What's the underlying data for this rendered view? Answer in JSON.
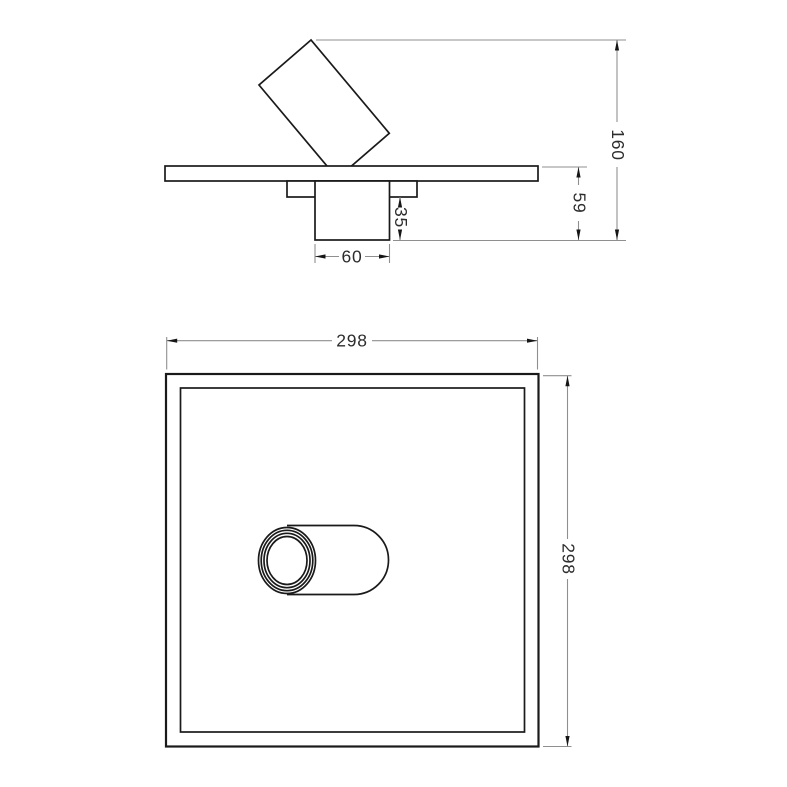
{
  "drawing": {
    "kind": "technical-dimension-drawing",
    "views": [
      "side-elevation",
      "bottom-plan"
    ],
    "subject": "square ceiling panel with adjustable spot head and mounting box"
  },
  "dimensions": {
    "side_view": {
      "overall_height": "160",
      "plate_to_box_bottom": "59",
      "box_height": "35",
      "box_width": "60"
    },
    "bottom_view": {
      "panel_width": "298",
      "panel_height": "298"
    }
  },
  "colors": {
    "background": "#ffffff",
    "geometry": "#1a1a1a",
    "dimension_lines": "#8f8f8f",
    "dimension_text": "#2d2d2d"
  }
}
